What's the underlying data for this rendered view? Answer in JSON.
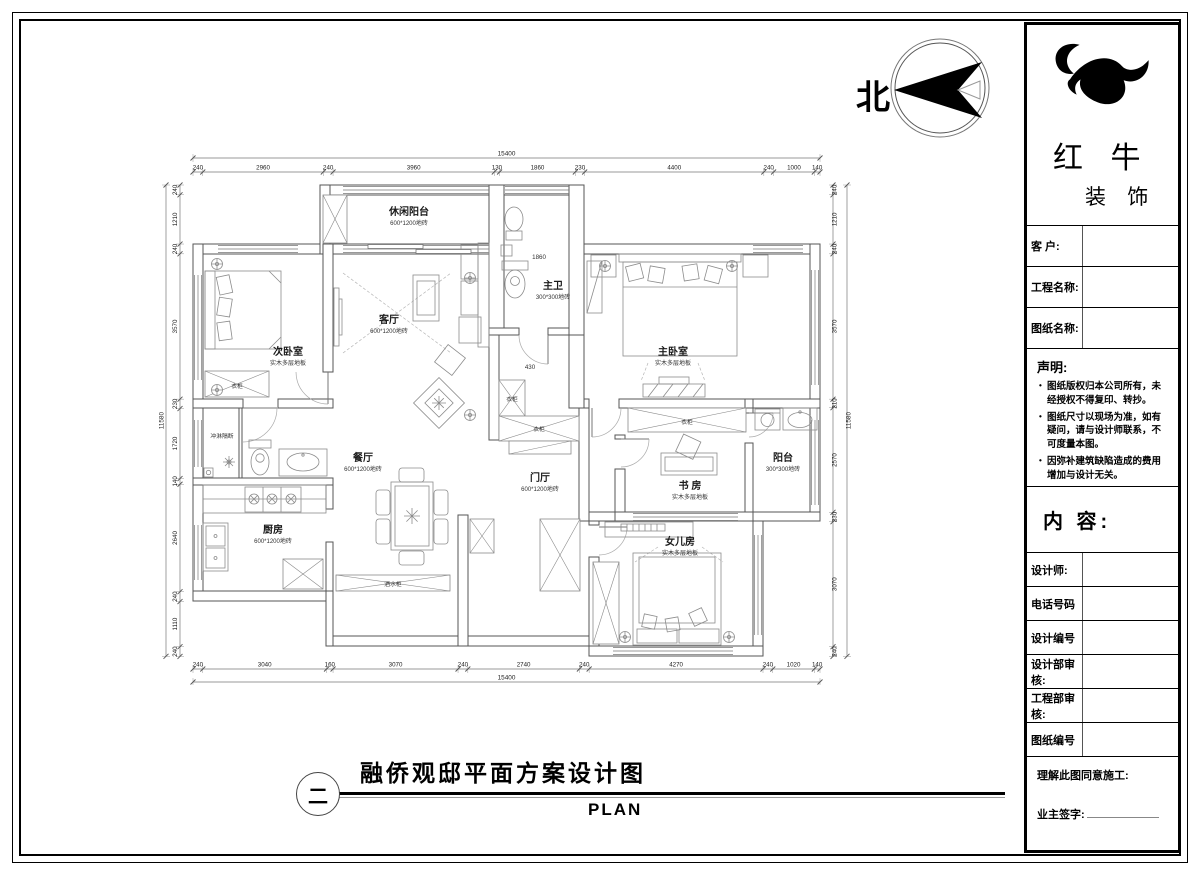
{
  "north": {
    "label": "北"
  },
  "footer": {
    "sheet_index": "二",
    "title": "融侨观邸平面方案设计图",
    "plan_label": "PLAN"
  },
  "title_block": {
    "brand": {
      "name_top": "红 牛",
      "name_bottom": "装 饰"
    },
    "fields": [
      {
        "label": "客 户:"
      },
      {
        "label": "工程名称:"
      },
      {
        "label": "图纸名称:"
      }
    ],
    "statement": {
      "title": "声明:",
      "items": [
        "图纸版权归本公司所有，未经授权不得复印、转抄。",
        "图纸尺寸以现场为准，如有疑问，请与设计师联系，不可度量本图。",
        "因弥补建筑缺陷造成的费用增加与设计无关。"
      ]
    },
    "content_label": "内 容:",
    "info_rows": [
      {
        "label": "设计师:"
      },
      {
        "label": "电话号码"
      },
      {
        "label": "设计编号"
      },
      {
        "label": "设计部审核:"
      },
      {
        "label": "工程部审核:"
      },
      {
        "label": "图纸编号"
      }
    ],
    "agreement": "理解此图同意施工:",
    "signature": "业主签字:"
  },
  "plan": {
    "rooms": [
      {
        "id": "xiuxian",
        "name": "休闲阳台",
        "sub": "600*1200地砖"
      },
      {
        "id": "ciwo",
        "name": "次卧室",
        "sub": "实木多层地板"
      },
      {
        "id": "keting",
        "name": "客厅",
        "sub": "600*1200地砖"
      },
      {
        "id": "zhuwei",
        "name": "主卫",
        "sub": "300*300地砖"
      },
      {
        "id": "zhuwo",
        "name": "主卧室",
        "sub": "实木多层地板"
      },
      {
        "id": "canting",
        "name": "餐厅",
        "sub": "600*1200地砖"
      },
      {
        "id": "menting",
        "name": "门厅",
        "sub": "600*1200地砖"
      },
      {
        "id": "shufang",
        "name": "书 房",
        "sub": "实木多层地板"
      },
      {
        "id": "yangtai",
        "name": "阳台",
        "sub": "300*300地砖"
      },
      {
        "id": "chufang",
        "name": "厨房",
        "sub": "600*1200地砖"
      },
      {
        "id": "nverfang",
        "name": "女儿房",
        "sub": "实木多层地板"
      }
    ],
    "annotations": [
      {
        "id": "wardrobe-ciwo",
        "label": "衣柜"
      },
      {
        "id": "wardrobe-corridor",
        "label": "衣柜"
      },
      {
        "id": "wardrobe-vertical",
        "label": "衣柜"
      },
      {
        "id": "wardrobe-horizontal",
        "label": "衣柜"
      },
      {
        "id": "shower-partition",
        "label": "冲淋隔断"
      },
      {
        "id": "wine-cabinet",
        "label": "酒水柜"
      },
      {
        "id": "dim-1860",
        "label": "1860"
      },
      {
        "id": "dim-430",
        "label": "430"
      }
    ],
    "dims": {
      "top": [
        240,
        2960,
        240,
        3960,
        130,
        1860,
        230,
        4400,
        240,
        1000,
        140
      ],
      "bottom": [
        240,
        3040,
        160,
        3070,
        240,
        2740,
        240,
        4270,
        240,
        1020,
        140
      ],
      "left": [
        240,
        1210,
        240,
        3570,
        230,
        1720,
        140,
        2640,
        240,
        1110,
        240
      ],
      "right": [
        240,
        1210,
        240,
        3570,
        210,
        2570,
        230,
        3070,
        240
      ],
      "total_width": "15400",
      "total_height": "11580"
    }
  }
}
